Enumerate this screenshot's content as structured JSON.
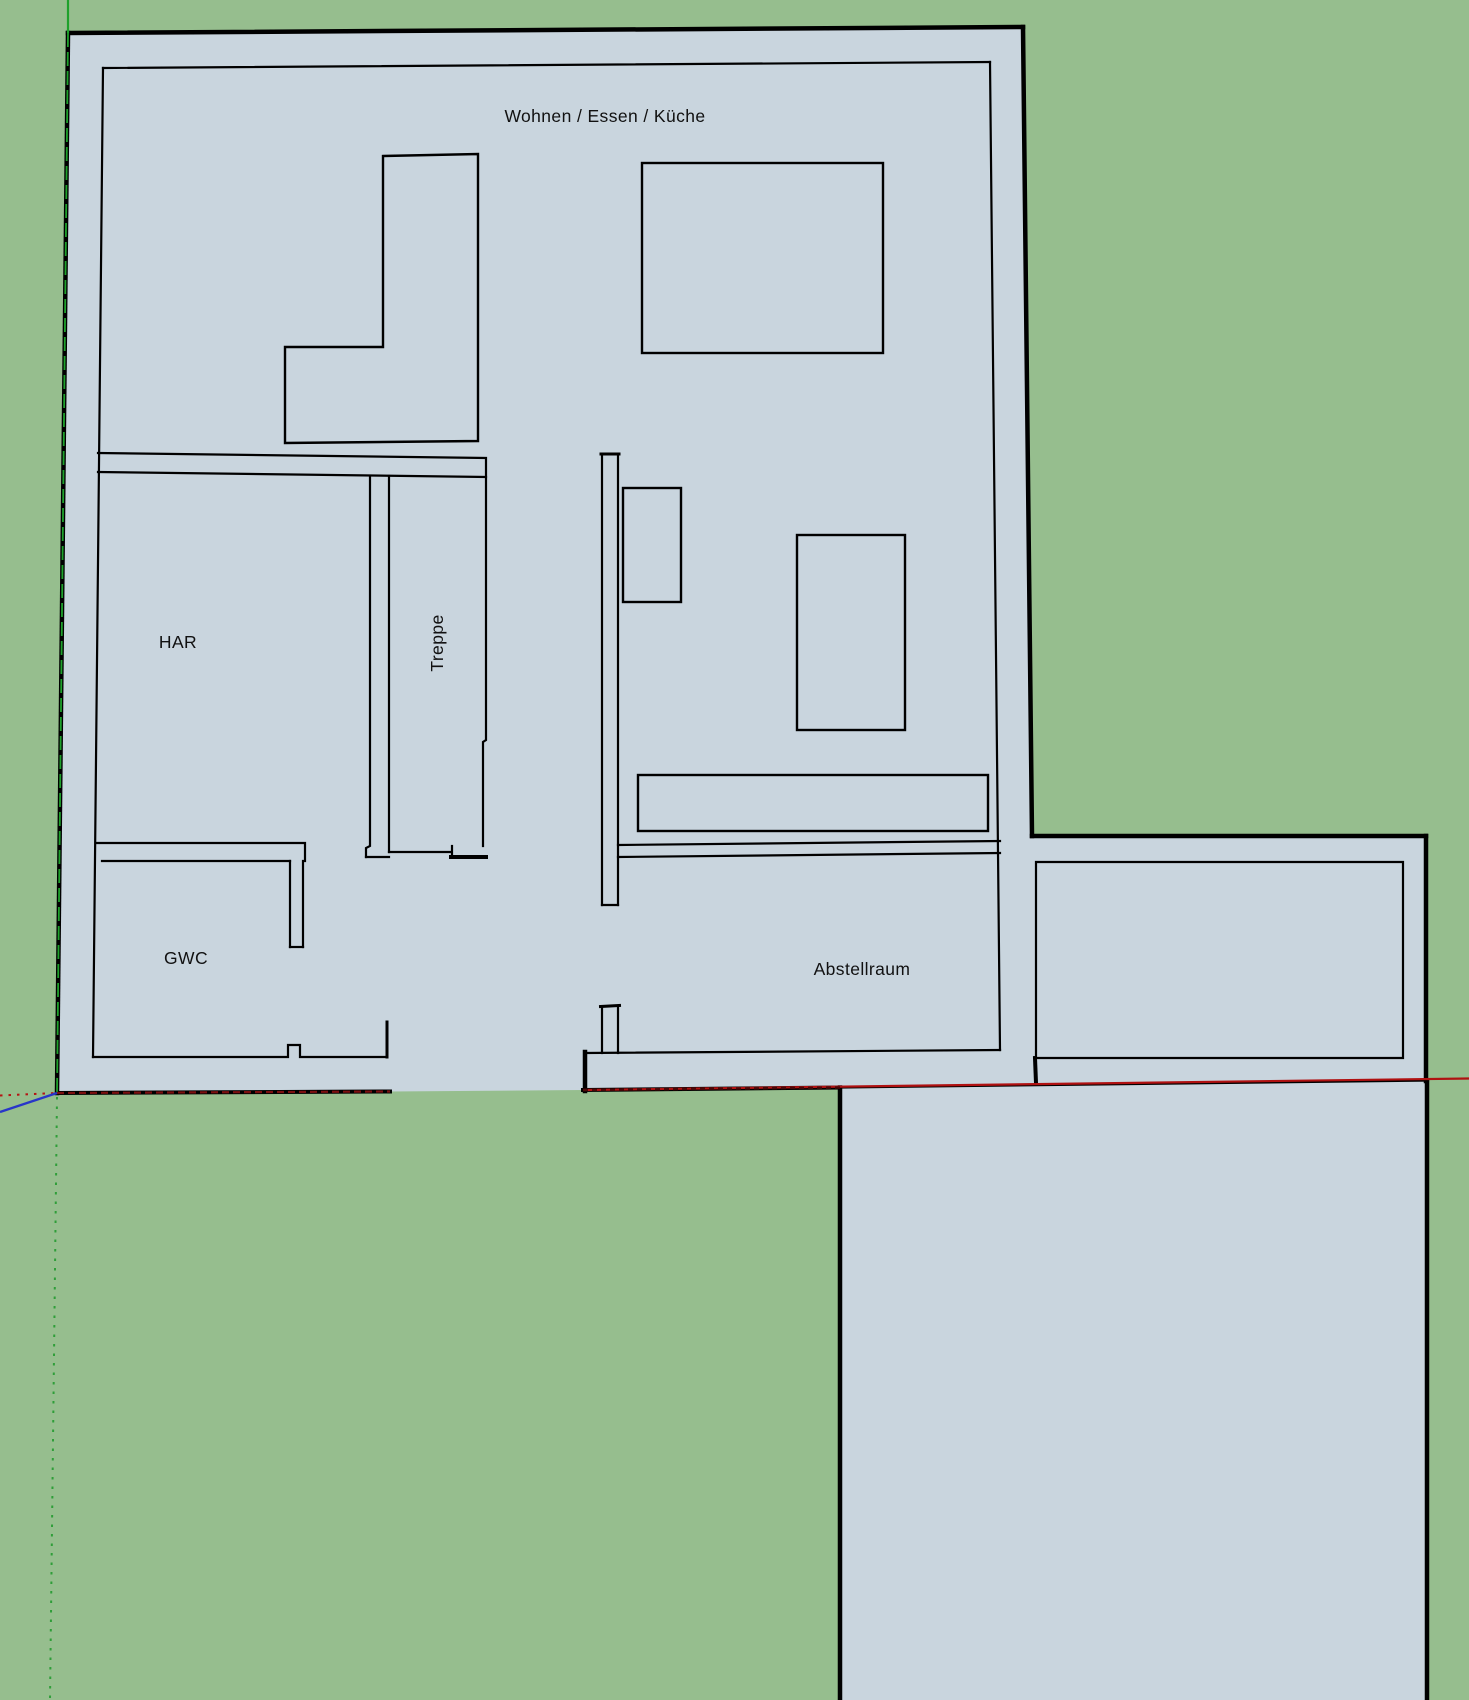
{
  "scene": {
    "ground_color": "#96be8e",
    "floor_color": "#c9d5de",
    "outline_color": "#000000",
    "view": "top-down floor plan on ground plane"
  },
  "rooms": {
    "living": {
      "label": "Wohnen / Essen / Küche"
    },
    "har": {
      "label": "HAR"
    },
    "stairs": {
      "label": "Treppe"
    },
    "gwc": {
      "label": "GWC"
    },
    "storage": {
      "label": "Abstellraum"
    }
  },
  "axes": {
    "x_axis": {
      "color_solid": "#b01111",
      "color_over_edge": "#7c1010",
      "style_negative": "dotted"
    },
    "y_axis": {
      "color_solid": "#1ea12b",
      "color_negative": "#2f9e39",
      "style_negative": "dotted"
    },
    "z_axis": {
      "color_solid": "#2836c9"
    }
  }
}
